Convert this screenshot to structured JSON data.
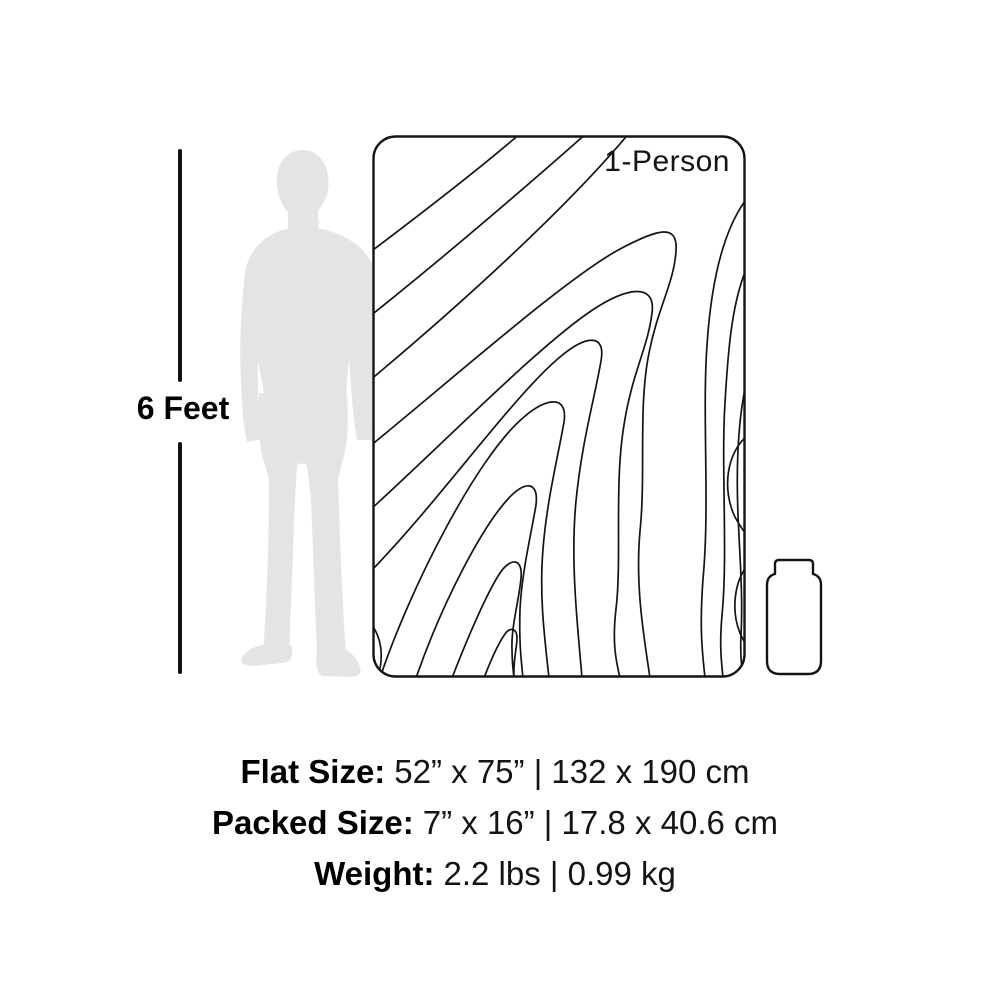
{
  "colors": {
    "background": "#ffffff",
    "ink": "#141414",
    "silhouette_gray": "#e4e4e4"
  },
  "ruler": {
    "label": "6 Feet"
  },
  "blanket": {
    "badge": "1-Person"
  },
  "specs": {
    "rows": [
      {
        "label": "Flat Size:",
        "value": "52” x 75” | 132 x 190 cm"
      },
      {
        "label": "Packed Size:",
        "value": "7” x 16” | 17.8 x 40.6 cm"
      },
      {
        "label": "Weight:",
        "value": "2.2 lbs | 0.99 kg"
      }
    ]
  }
}
